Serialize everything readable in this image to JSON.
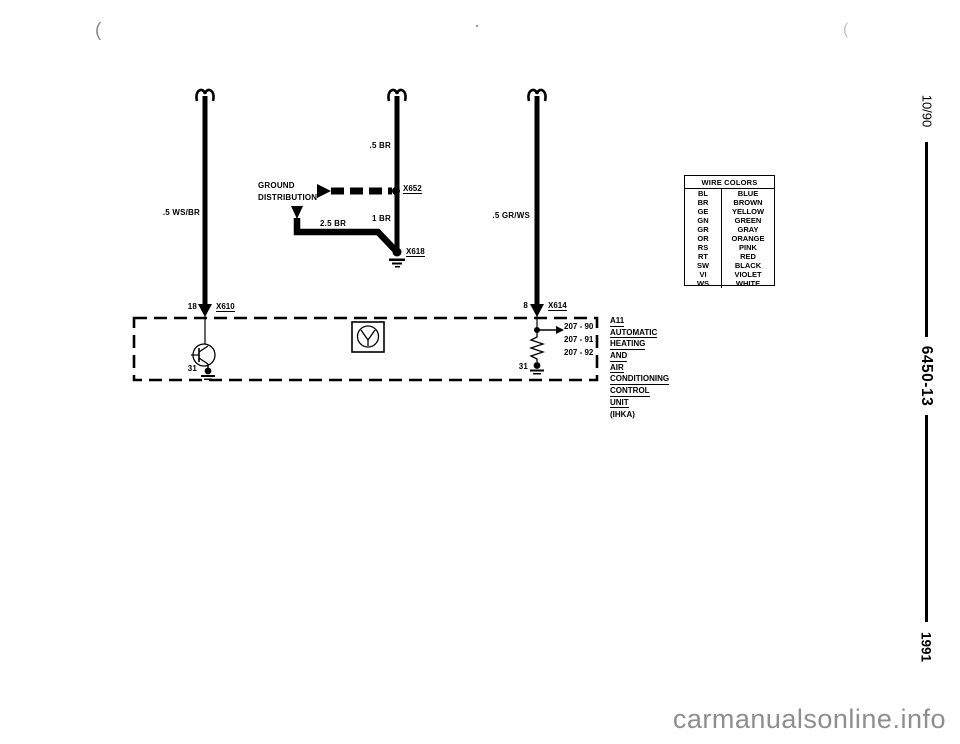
{
  "page": {
    "artifact_left": "(",
    "artifact_right": "(",
    "watermark": "carmanualsonline.info"
  },
  "sidebar": {
    "issue": "10/90",
    "doc_number": "6450-13",
    "year": "1991"
  },
  "wire_colors": {
    "title": "WIRE COLORS",
    "rows": [
      {
        "code": "BL",
        "name": "BLUE"
      },
      {
        "code": "BR",
        "name": "BROWN"
      },
      {
        "code": "GE",
        "name": "YELLOW"
      },
      {
        "code": "GN",
        "name": "GREEN"
      },
      {
        "code": "GR",
        "name": "GRAY"
      },
      {
        "code": "OR",
        "name": "ORANGE"
      },
      {
        "code": "RS",
        "name": "PINK"
      },
      {
        "code": "RT",
        "name": "RED"
      },
      {
        "code": "SW",
        "name": "BLACK"
      },
      {
        "code": "VI",
        "name": "VIOLET"
      },
      {
        "code": "WS",
        "name": "WHITE"
      }
    ]
  },
  "diagram": {
    "ground_distribution": {
      "line1": "GROUND",
      "line2": "DISTRIBUTION"
    },
    "wire_labels": {
      "left": ".5 WS/BR",
      "mid_upper": ".5 BR",
      "mid_lower": "1 BR",
      "ground_feed": "2.5 BR",
      "right": ".5 GR/WS"
    },
    "connectors": {
      "splice": "X652",
      "ground_point": "X618",
      "left_plug": "X610",
      "right_plug": "X614"
    },
    "pins": {
      "left": "18",
      "right": "8",
      "left_ground": "31",
      "right_ground": "31"
    },
    "refs": [
      "207 - 90",
      "207 - 91",
      "207 - 92"
    ],
    "unit": {
      "lines": [
        "A11",
        "AUTOMATIC",
        "HEATING",
        "AND",
        "AIR",
        "CONDITIONING",
        "CONTROL",
        "UNIT"
      ],
      "note": "(IHKA)"
    }
  }
}
